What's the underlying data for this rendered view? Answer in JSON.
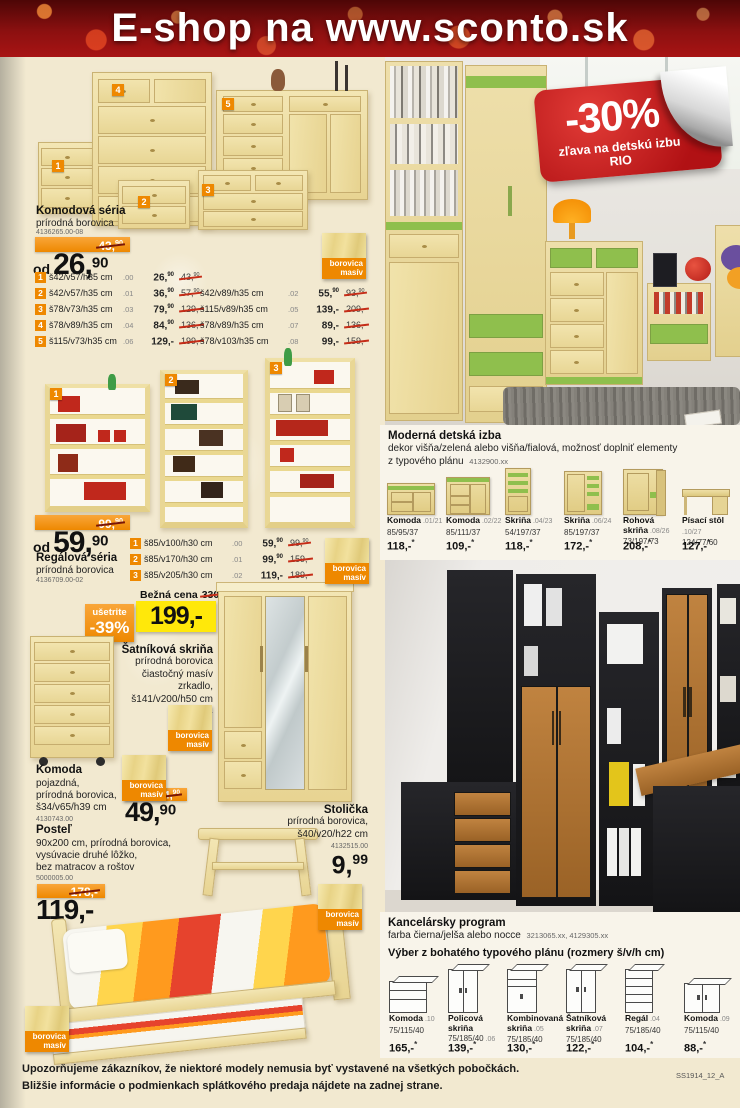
{
  "header": {
    "title": "E-shop na www.sconto.sk"
  },
  "colors": {
    "accent_orange": "#ee8800",
    "sticker_red": "#c8191e",
    "price_yellow": "#ffe80a",
    "kids_green": "#8fbf4d"
  },
  "badge": {
    "borovica": "borovica",
    "masiv": "masív"
  },
  "komodova": {
    "title": "Komodová séria",
    "material": "prírodná borovica",
    "code": "4136265.00-08",
    "old_price": "43,",
    "old_sup": "90",
    "od": "od",
    "price": "26,",
    "price_sup": "90",
    "tags": [
      "1",
      "2",
      "3",
      "4",
      "5"
    ],
    "rows_left": [
      {
        "n": "1",
        "dims": "š42/v57/h35 cm",
        "v": ".00",
        "p": "26,",
        "ps": "90",
        "o": "43,",
        "os": "90"
      },
      {
        "n": "2",
        "dims": "š42/v57/h35 cm",
        "v": ".01",
        "p": "36,",
        "ps": "90",
        "o": "57,",
        "os": "90"
      },
      {
        "n": "3",
        "dims": "š78/v73/h35 cm",
        "v": ".03",
        "p": "79,",
        "ps": "90",
        "o": "129,-",
        "os": ""
      },
      {
        "n": "4",
        "dims": "š78/v89/h35 cm",
        "v": ".04",
        "p": "84,",
        "ps": "90",
        "o": "136,-",
        "os": ""
      },
      {
        "n": "5",
        "dims": "š115/v73/h35 cm",
        "v": ".06",
        "p": "129,-",
        "ps": "",
        "o": "199,-",
        "os": ""
      }
    ],
    "rows_right": [
      {
        "dims": "š42/v89/h35 cm",
        "v": ".02",
        "p": "55,",
        "ps": "90",
        "o": "93,",
        "os": "90"
      },
      {
        "dims": "š115/v89/h35 cm",
        "v": ".05",
        "p": "139,-",
        "ps": "",
        "o": "209,-",
        "os": ""
      },
      {
        "dims": "š78/v89/h35 cm",
        "v": ".07",
        "p": "89,-",
        "ps": "",
        "o": "136,-",
        "os": ""
      },
      {
        "dims": "š78/v103/h35 cm",
        "v": ".08",
        "p": "99,-",
        "ps": "",
        "o": "159,-",
        "os": ""
      }
    ]
  },
  "regalova": {
    "title": "Regálová séria",
    "material": "prírodná borovica",
    "code": "4136709.00-02",
    "old_price": "99,",
    "old_sup": "90",
    "od": "od",
    "price": "59,",
    "price_sup": "90",
    "tags": [
      "1",
      "2",
      "3"
    ],
    "rows": [
      {
        "n": "1",
        "dims": "š85/v100/h30 cm",
        "v": ".00",
        "p": "59,",
        "ps": "90",
        "o": "99,",
        "os": "90"
      },
      {
        "n": "2",
        "dims": "š85/v170/h30 cm",
        "v": ".01",
        "p": "99,",
        "ps": "90",
        "o": "159,-",
        "os": ""
      },
      {
        "n": "3",
        "dims": "š85/v205/h30 cm",
        "v": ".02",
        "p": "119,-",
        "ps": "",
        "o": "189,-",
        "os": ""
      }
    ]
  },
  "satnikova": {
    "bezna_label": "Bežná cena",
    "bezna_value": "330,-",
    "usetrite": "ušetrite",
    "discount": "-39%",
    "price": "199,-",
    "title": "Šatníková skriňa",
    "lines": [
      "prírodná borovica",
      "čiastočný masív",
      "zrkadlo,",
      "š141/v200/h50 cm"
    ],
    "code": "4135828.01"
  },
  "komoda_pojazdna": {
    "title": "Komoda",
    "lines": [
      "pojazdná,",
      "prírodná borovica,",
      "š34/v65/h39 cm"
    ],
    "code": "4130743.00",
    "old_price": "64,",
    "old_sup": "90",
    "price": "49,",
    "price_sup": "90"
  },
  "stolicka": {
    "title": "Stolička",
    "lines": [
      "prírodná borovica,",
      "š40/v20/h22 cm"
    ],
    "code": "4132515.00",
    "price": "9,",
    "price_sup": "99"
  },
  "postel": {
    "title": "Posteľ",
    "lines": [
      "90x200 cm, prírodná borovica,",
      "vysúvacie druhé lôžko,",
      "bez matracov a roštov"
    ],
    "code": "5000005.00",
    "old_price": "178,-",
    "price": "119,-"
  },
  "sticker": {
    "percent": "-30%",
    "line1": "zľava na detskú izbu",
    "line2": "RIO"
  },
  "detska": {
    "title": "Moderná detská izba",
    "desc1": "dekor višňa/zelená alebo višňa/fialová, možnosť doplniť elementy",
    "desc2": "z typového plánu",
    "code": "4132900.xx",
    "products": [
      {
        "name": "Komoda",
        "v": ".01/21",
        "dims": "85/95/37",
        "price": "118,-",
        "star": "*"
      },
      {
        "name": "Komoda",
        "v": ".02/22",
        "dims": "85/111/37",
        "price": "109,-",
        "star": "*"
      },
      {
        "name": "Skriňa",
        "v": ".04/23",
        "dims": "54/197/37",
        "price": "118,-",
        "star": "*"
      },
      {
        "name": "Skriňa",
        "v": ".06/24",
        "dims": "85/197/37",
        "price": "172,-",
        "star": "*"
      },
      {
        "name": "Rohová skriňa",
        "v": ".08/26",
        "dims": "73/197/73",
        "price": "208,-",
        "star": "*"
      },
      {
        "name": "Písací stôl",
        "v": ".10/27",
        "dims": "124/77/60",
        "price": "127,-",
        "star": "*"
      }
    ]
  },
  "kancelarsky": {
    "title": "Kancelársky program",
    "desc": "farba čierna/jelša alebo nocce",
    "codes": "3213065.xx, 4129305.xx",
    "subtitle": "Výber z bohatého typového plánu (rozmery š/v/h cm)",
    "products": [
      {
        "name": "Komoda",
        "v": ".10",
        "dims": "75/115/40",
        "price": "165,-",
        "star": "*"
      },
      {
        "name": "Policová skriňa",
        "v": ".06",
        "dims": "75/185/40",
        "price": "139,-",
        "star": "*"
      },
      {
        "name": "Kombinovaná skriňa",
        "v": ".05",
        "dims": "75/185/40",
        "price": "130,-",
        "star": "*"
      },
      {
        "name": "Šatníková skriňa",
        "v": ".07",
        "dims": "75/185/40",
        "price": "122,-",
        "star": "*"
      },
      {
        "name": "Regál",
        "v": ".04",
        "dims": "75/185/40",
        "price": "104,-",
        "star": "*"
      },
      {
        "name": "Komoda",
        "v": ".09",
        "dims": "75/115/40",
        "price": "88,-",
        "star": "*"
      }
    ]
  },
  "footer": {
    "line1": "Upozorňujeme zákazníkov, že niektoré modely nemusia byť vystavené na všetkých pobočkách.",
    "line2": "Bližšie informácie o podmienkach splátkového predaja nájdete na zadnej strane.",
    "code": "SS1914_12_A"
  }
}
